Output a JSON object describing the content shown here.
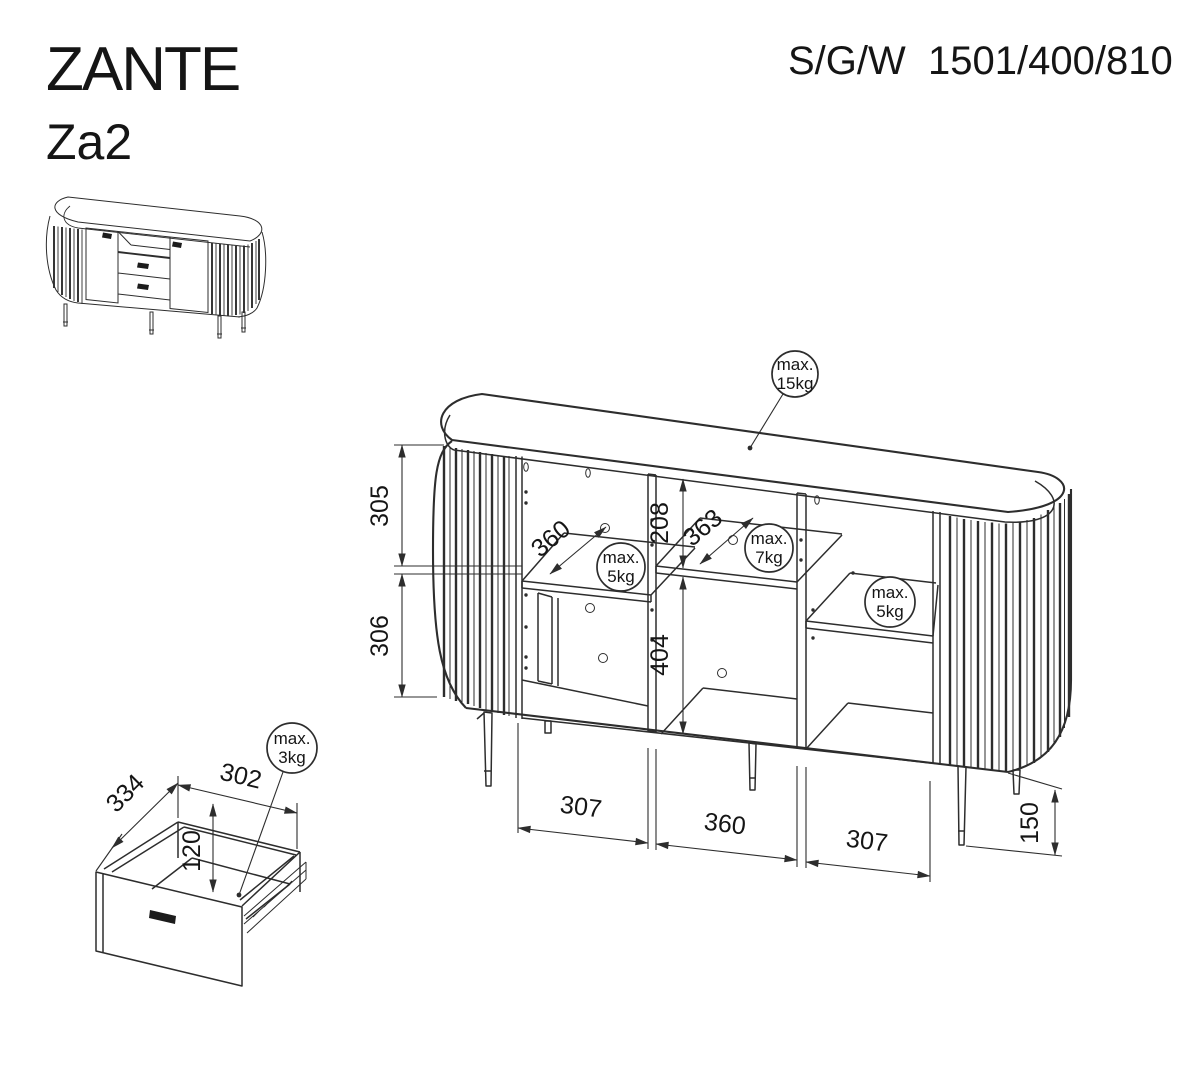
{
  "header": {
    "title": "ZANTE",
    "model": "Za2",
    "spec_label": "S/G/W",
    "spec_value": "1501/400/810"
  },
  "main_drawing": {
    "dim_upper_height": "305",
    "dim_lower_height": "306",
    "dim_top_gap": "208",
    "dim_bottom_gap": "404",
    "dim_left_shelf_depth": "360",
    "dim_mid_shelf_depth": "363",
    "dim_left_width": "307",
    "dim_mid_width": "360",
    "dim_right_width": "307",
    "dim_leg_height": "150",
    "load_top_line1": "max.",
    "load_top_line2": "15kg",
    "load_left_line1": "max.",
    "load_left_line2": "5kg",
    "load_mid_line1": "max.",
    "load_mid_line2": "7kg",
    "load_right_line1": "max.",
    "load_right_line2": "5kg"
  },
  "drawer_detail": {
    "dim_depth": "334",
    "dim_width": "302",
    "dim_inner_height": "120",
    "load_line1": "max.",
    "load_line2": "3kg"
  },
  "colors": {
    "line": "#2d2d2d",
    "text": "#151515",
    "background": "#ffffff"
  }
}
